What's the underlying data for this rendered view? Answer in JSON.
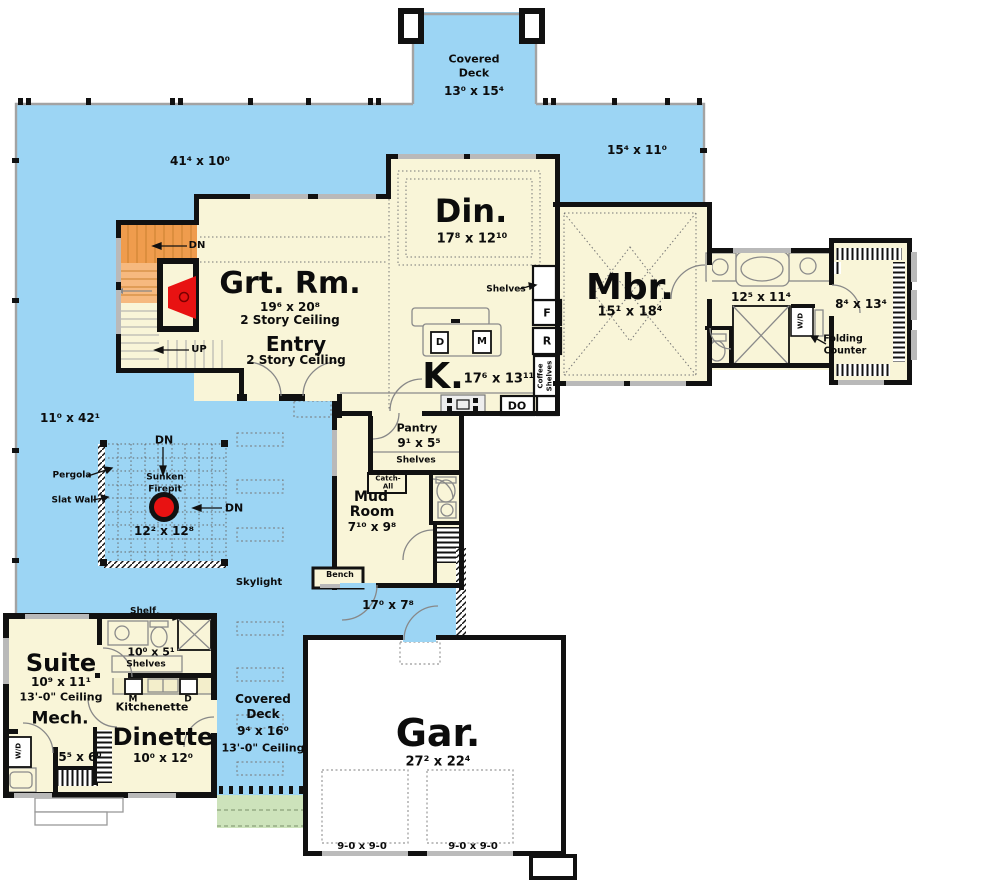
{
  "colors": {
    "deck_blue": "#9cd5f4",
    "room_cream": "#f9f5d8",
    "stair_orange_dark": "#ef9c4d",
    "stair_orange_light": "#f6b97f",
    "firepit_red": "#e81212",
    "patio_green": "#cde3bb",
    "wall_black": "#111111",
    "line_gray": "#999999"
  },
  "deck": {
    "top_covered": {
      "line1": "Covered",
      "line2": "Deck",
      "dims": "13⁰ x 15⁴"
    },
    "upper": "41⁴ x 10⁰",
    "right": "15⁴ x 11⁰",
    "west": "11⁰ x 42¹",
    "lower": "17⁰ x 7⁸",
    "skylight": "Skylight",
    "south_covered": {
      "line1": "Covered",
      "line2": "Deck",
      "dims": "9⁴ x 16⁰",
      "ceiling": "13'-0\" Ceiling"
    }
  },
  "pergola": {
    "label": "Pergola",
    "slat_wall": "Slat Wall",
    "sunken1": "Sunken",
    "sunken2": "Firepit",
    "dims": "12² x 12⁸",
    "dn_top": "DN",
    "dn_side": "DN"
  },
  "stairs": {
    "dn": "DN",
    "up": "UP"
  },
  "rooms": {
    "great": {
      "name": "Grt. Rm.",
      "dims": "19⁶ x 20⁸",
      "ceiling": "2 Story Ceiling"
    },
    "entry": {
      "name": "Entry",
      "ceiling": "2 Story Ceiling"
    },
    "dining": {
      "name": "Din.",
      "dims": "17⁸ x 12¹⁰"
    },
    "master": {
      "name": "Mbr.",
      "dims": "15¹ x 18⁴"
    },
    "master_bath": {
      "dims": "12⁵ x 11⁴"
    },
    "wic": {
      "dims": "8⁴ x 13⁴",
      "folding1": "Folding",
      "folding2": "Counter",
      "wd": "W/D"
    },
    "kitchen": {
      "name": "K.",
      "dims": "17⁶ x 13¹¹",
      "f": "F",
      "r": "R",
      "do_label": "DO",
      "island_d": "D",
      "island_m": "M",
      "coffee1": "Coffee",
      "coffee2": "Shelves",
      "shelves": "Shelves"
    },
    "pantry": {
      "name": "Pantry",
      "dims": "9¹ x 5⁵",
      "shelves": "Shelves",
      "catch1": "Catch-",
      "catch2": "All"
    },
    "mud": {
      "name1": "Mud",
      "name2": "Room",
      "dims": "7¹⁰ x 9⁸",
      "bench": "Bench"
    },
    "suite": {
      "name": "Suite",
      "dims": "10⁹ x 11¹",
      "ceiling": "13'-0\" Ceiling"
    },
    "suite_bath": {
      "dims": "10⁰ x 5¹",
      "shelves": "Shelves",
      "shelf": "Shelf"
    },
    "kitchenette": {
      "name": "Kitchenette",
      "m": "M",
      "d": "D"
    },
    "mech": {
      "name": "Mech.",
      "dims": "5⁵ x 6⁰",
      "wd": "W/D"
    },
    "dinette": {
      "name": "Dinette",
      "dims": "10⁰ x 12⁰"
    },
    "garage": {
      "name": "Gar.",
      "dims": "27² x 22⁴",
      "door1": "9-0 x 9-0",
      "door2": "9-0 x 9-0"
    }
  }
}
